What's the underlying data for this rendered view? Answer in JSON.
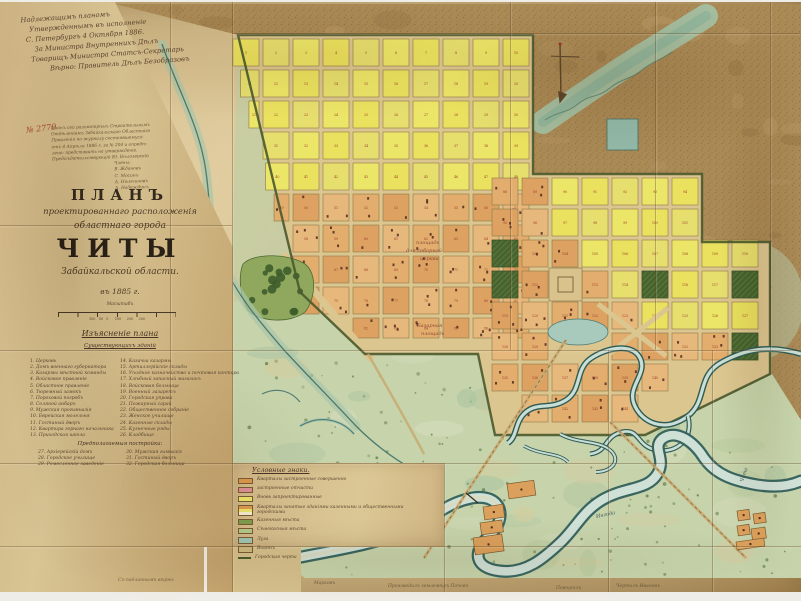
{
  "map_title_meta": "Планъ города Читы 1885",
  "annotations": {
    "top_note_lines": [
      "Надлежащимъ планомъ",
      "Утвержденнымъ въ исполненіе",
      "С. Петербургъ 4 Октября 1886.",
      "За Министра Внутреннихъ Дѣлъ",
      "Товарищъ Министра Статсъ-Секретарь",
      "Вѣрно: Правитель Дѣлъ Безобразовъ"
    ],
    "number_stamp": "№ 2770",
    "bottom_notes": [
      {
        "text": "Съ подлиннымъ вѣрно:",
        "x": 118,
        "y": 578
      },
      {
        "text": "Марковъ",
        "x": 314,
        "y": 581
      },
      {
        "text": "Производилъ землемѣръ Поповъ",
        "x": 388,
        "y": 584
      },
      {
        "text": "Повѣрялъ",
        "x": 556,
        "y": 586
      },
      {
        "text": "Чертилъ Ивановъ",
        "x": 616,
        "y": 584
      }
    ]
  },
  "title_block": {
    "cert_lines": [
      "Планъ сей разсмотрѣнъ Строительнымъ",
      "Отдѣленіемъ Забайкальскаго Областнаго",
      "Правленія по журналу состоявшемуся",
      "отъ 4 Апрѣля 1886 г. за № 204 и опредѣ-",
      "лено: представить на утвержденіе.",
      "Предсѣдательствующій Ю. Бѣлозерскій"
    ],
    "cert_signatures": [
      "Члены:",
      "В. Ждановъ",
      "С. Мосинъ",
      "А. Нѣмчиновъ",
      "А. Надеждинъ"
    ],
    "plan_word": "ПЛАНЪ",
    "subtitle1": "проектированнаго расположенія",
    "subtitle2": "областнаго города",
    "city": "ЧИТЫ",
    "region": "Забайкальской области.",
    "year": "въ 1885 г.",
    "scale_word": "Масштабъ",
    "scale_labels": "100   50   0      100     200     300",
    "legend_title": "Изъясненіе плана",
    "legend_subtitle": "Существующихъ зданій",
    "legend_left": [
      "1. Церковь",
      "2. Домъ военнаго губернатора",
      "3. Казармы мѣстной команды",
      "4. Войсковое правленіе",
      "5. Областное правленіе",
      "6. Тюремный замокъ",
      "7. Пороховой погребъ",
      "8. Соляной анбаръ",
      "9. Мужская прогимназія",
      "10. Еврейская молельня",
      "11. Гостиный дворъ",
      "12. Квартира горнаго начальника",
      "13. Приходская школа"
    ],
    "legend_right": [
      "14. Казачьи казармы",
      "15. Артиллерійскіе склады",
      "16. Уѣздное казначейство и почтовая контора",
      "17. Хлѣбный запасный магазинъ",
      "18. Войсковая больница",
      "19. Военный лазаретъ",
      "20. Городская управа",
      "21. Пожарный сарай",
      "22. Общественное собраніе",
      "23. Женское училище",
      "24. Казенные склады",
      "25. Кузнечные ряды",
      "26. Кладбище"
    ],
    "proposed_title": "Предполагаемыя постройки:",
    "proposed_left": [
      "27. Архіерейскій домъ",
      "28. Городское училище",
      "29. Ремесленное заведеніе"
    ],
    "proposed_right": [
      "30. Мужская гимназія",
      "31. Гостиный дворъ",
      "32. Городская больница"
    ]
  },
  "signs_panel": {
    "title": "Условные знаки.",
    "items": [
      {
        "swatch": "#dc9a4e",
        "label": "Кварталы застроенные совершенно"
      },
      {
        "swatch": "#dd8f96",
        "label": "застроенные отчасти"
      },
      {
        "swatch": "#ebe26b",
        "label": "Вновь запроектированные"
      },
      {
        "swatch": "multi",
        "label": "Кварталы занятые зданіями казенными и общественными городскими"
      },
      {
        "swatch": "#7e9c4c",
        "label": "Казенныя мѣста"
      },
      {
        "swatch": "#b4c98c",
        "label": "Сѣнокосныя мѣста"
      },
      {
        "swatch": "#9ec7b4",
        "label": "Луга"
      },
      {
        "swatch": "#cdb97e",
        "label": "Выгонъ"
      },
      {
        "swatch": "line",
        "label": "Городская черта"
      }
    ]
  },
  "map_labels": [
    {
      "text": "площадь",
      "x": 416,
      "y": 240,
      "rot": 0,
      "color": "#8b4937"
    },
    {
      "text": "для соборной",
      "x": 406,
      "y": 248,
      "rot": 0,
      "color": "#8b4937"
    },
    {
      "text": "церкви",
      "x": 420,
      "y": 256,
      "rot": 0,
      "color": "#8b4937"
    },
    {
      "text": "Базарная",
      "x": 417,
      "y": 323,
      "rot": 0,
      "color": "#8b4937"
    },
    {
      "text": "площадь",
      "x": 421,
      "y": 331,
      "rot": 0,
      "color": "#8b4937"
    },
    {
      "text": "Чита",
      "x": 737,
      "y": 472,
      "rot": -72,
      "color": "#3f5e58"
    },
    {
      "text": "Ингода",
      "x": 596,
      "y": 512,
      "rot": -12,
      "color": "#3f5e58"
    }
  ],
  "colors": {
    "paper": "#cdb280",
    "terrain": "#aa8a55",
    "block_yellow": "#eae263",
    "block_orange": "#e0a968",
    "park_green": "#47632f",
    "flood_green": "#c6d3ab",
    "river_dark": "#33605c",
    "river_light": "#cfe0d6",
    "boundary": "#4d5b2f",
    "ink": "#54412c",
    "red_ink": "#a8452e"
  }
}
